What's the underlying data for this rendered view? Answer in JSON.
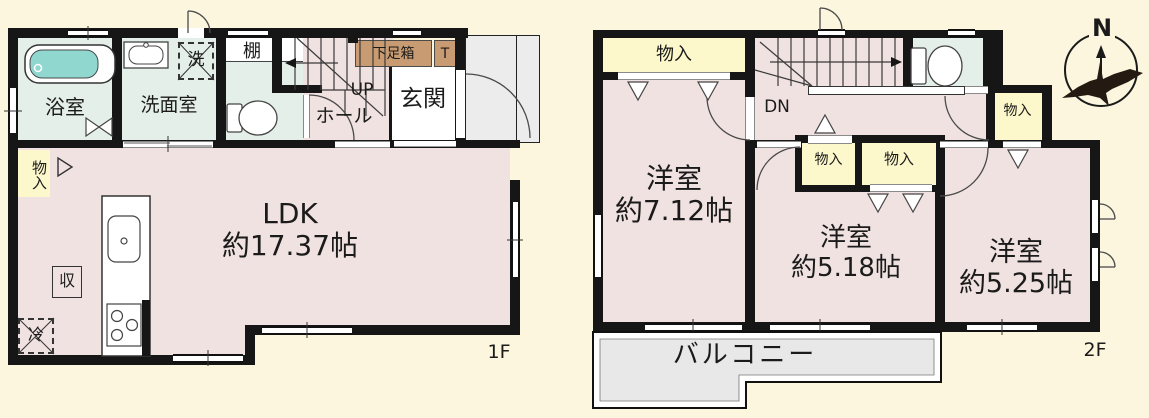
{
  "title": "間取り図",
  "floor1": {
    "floor_label": "1F",
    "rooms": {
      "bath": "浴室",
      "washroom": "洗面室",
      "washer": "洗",
      "shelf": "棚",
      "closet": "物入",
      "up": "UP",
      "hall": "ホール",
      "entrance": "玄関",
      "shoe_box": "下足箱",
      "toilet_mark": "T",
      "storage": "収",
      "fridge": "冷",
      "ldk": "LDK",
      "ldk_size": "約17.37帖"
    }
  },
  "floor2": {
    "floor_label": "2F",
    "rooms": {
      "closet_top": "物入",
      "down": "DN",
      "closet_hall": "物入",
      "closet_mid": "物入",
      "closet_right": "物入",
      "room1": "洋室",
      "room1_size": "約7.12帖",
      "room2": "洋室",
      "room2_size": "約5.18帖",
      "room3": "洋室",
      "room3_size": "約5.25帖",
      "balcony": "バルコニー"
    }
  },
  "compass": {
    "north": "N"
  },
  "colors": {
    "background": "#fbf6dd",
    "wall": "#161616",
    "room_pink": "#f0e2e0",
    "wet_green": "#e5efe9",
    "closet_yellow": "#fdf8cc",
    "porch_gray": "#ececec",
    "bathtub_teal": "#8fd7cf",
    "shoebox_brown": "#c89b72"
  }
}
